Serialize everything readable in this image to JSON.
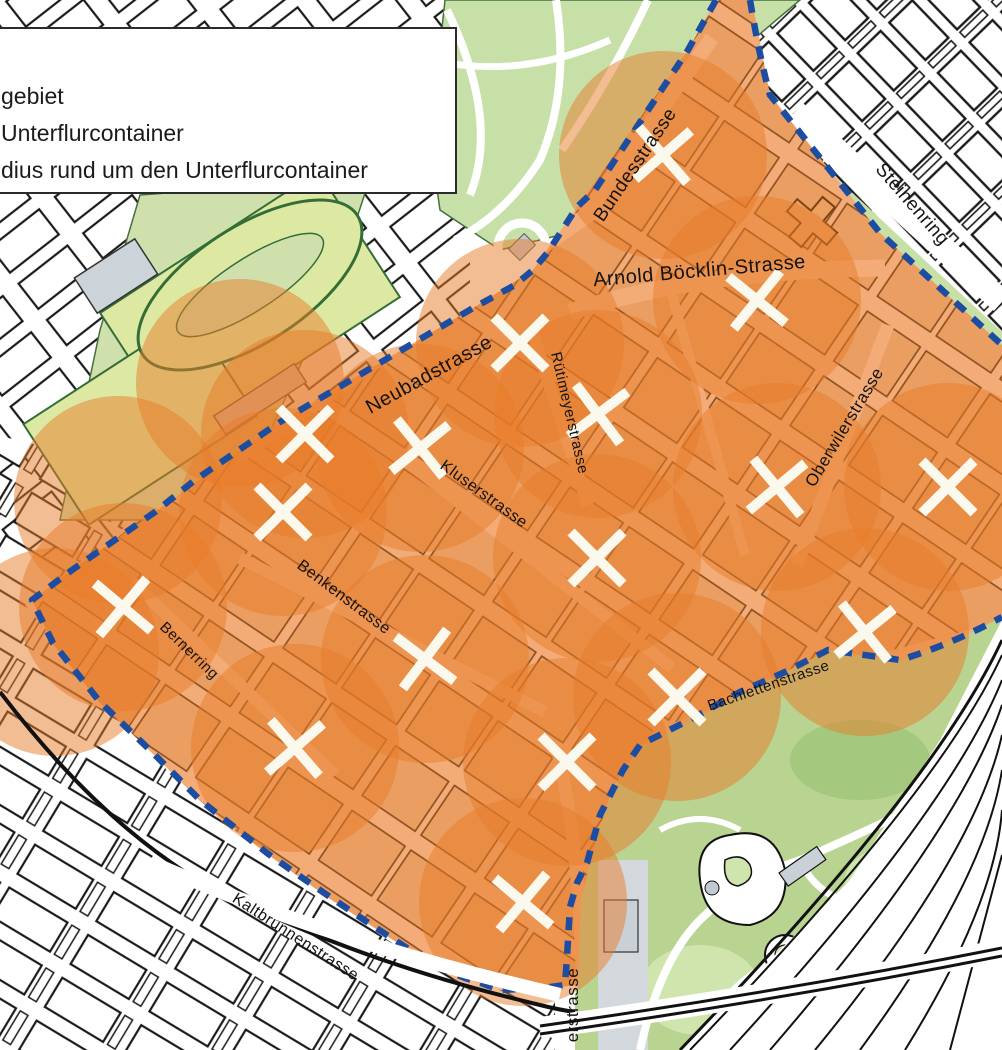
{
  "legend": {
    "items": [
      {
        "label": "gebiet"
      },
      {
        "label": "Unterflurcontainer"
      },
      {
        "label": "dius rund um den Unterflurcontainer"
      }
    ]
  },
  "map": {
    "circle_radius_px": 104,
    "colors": {
      "pilot_base": "#f3ac77",
      "building_fill": "#eb9e61",
      "building_outline": "#8a4c1b",
      "coverage_orange": "#e87c2a",
      "boundary_blue": "#1d4da1",
      "marker_white": "#fbf8ee",
      "park_green": "#c7e0a8",
      "sports_field_green": "#dde9a2",
      "zoo_green": "#b9d391",
      "gray_building": "#ccd3d9",
      "outside_line": "#1a1a1a",
      "label_color": "#141414"
    },
    "street_labels": [
      {
        "name": "Bundesstrasse",
        "x": 640,
        "y": 168,
        "rot": -56,
        "size": 19
      },
      {
        "name": "Steinenring",
        "x": 908,
        "y": 208,
        "rot": 49,
        "size": 19
      },
      {
        "name": "Arnold Böcklin-Strasse",
        "x": 700,
        "y": 277,
        "rot": -5,
        "size": 20
      },
      {
        "name": "Neubadstrasse",
        "x": 432,
        "y": 380,
        "rot": -29,
        "size": 20
      },
      {
        "name": "Rütimeyerstrasse",
        "x": 565,
        "y": 414,
        "rot": 77,
        "size": 15
      },
      {
        "name": "Kluserstrasse",
        "x": 481,
        "y": 498,
        "rot": 36,
        "size": 16
      },
      {
        "name": "Oberwilerstrasse",
        "x": 849,
        "y": 430,
        "rot": -59,
        "size": 17
      },
      {
        "name": "Benkenstrasse",
        "x": 341,
        "y": 601,
        "rot": 37,
        "size": 16
      },
      {
        "name": "Bernerring",
        "x": 186,
        "y": 654,
        "rot": 44,
        "size": 15
      },
      {
        "name": "Bachlettenstrasse",
        "x": 770,
        "y": 690,
        "rot": -19,
        "size": 15
      },
      {
        "name": "Kaltbrunnenstrasse",
        "x": 293,
        "y": 941,
        "rot": 33,
        "size": 16
      },
      {
        "name": "erstrasse",
        "x": 578,
        "y": 1005,
        "rot": -90,
        "size": 17
      }
    ],
    "containers": [
      {
        "x": 663,
        "y": 155,
        "rot": 4
      },
      {
        "x": 757,
        "y": 300,
        "rot": -6
      },
      {
        "x": 520,
        "y": 343,
        "rot": 0
      },
      {
        "x": 598,
        "y": 414,
        "rot": 8
      },
      {
        "x": 305,
        "y": 434,
        "rot": 0
      },
      {
        "x": 420,
        "y": 448,
        "rot": 6
      },
      {
        "x": 283,
        "y": 512,
        "rot": 0
      },
      {
        "x": 123,
        "y": 607,
        "rot": -5
      },
      {
        "x": 597,
        "y": 558,
        "rot": 0
      },
      {
        "x": 777,
        "y": 487,
        "rot": 5
      },
      {
        "x": 948,
        "y": 487,
        "rot": 0
      },
      {
        "x": 425,
        "y": 659,
        "rot": -8
      },
      {
        "x": 865,
        "y": 632,
        "rot": 6
      },
      {
        "x": 677,
        "y": 697,
        "rot": 0
      },
      {
        "x": 295,
        "y": 748,
        "rot": 4
      },
      {
        "x": 567,
        "y": 762,
        "rot": 0
      },
      {
        "x": 523,
        "y": 902,
        "rot": -5
      }
    ],
    "extra_coverage_circles": [
      {
        "x": 240,
        "y": 383
      },
      {
        "x": 118,
        "y": 500
      },
      {
        "x": 55,
        "y": 652
      }
    ]
  }
}
